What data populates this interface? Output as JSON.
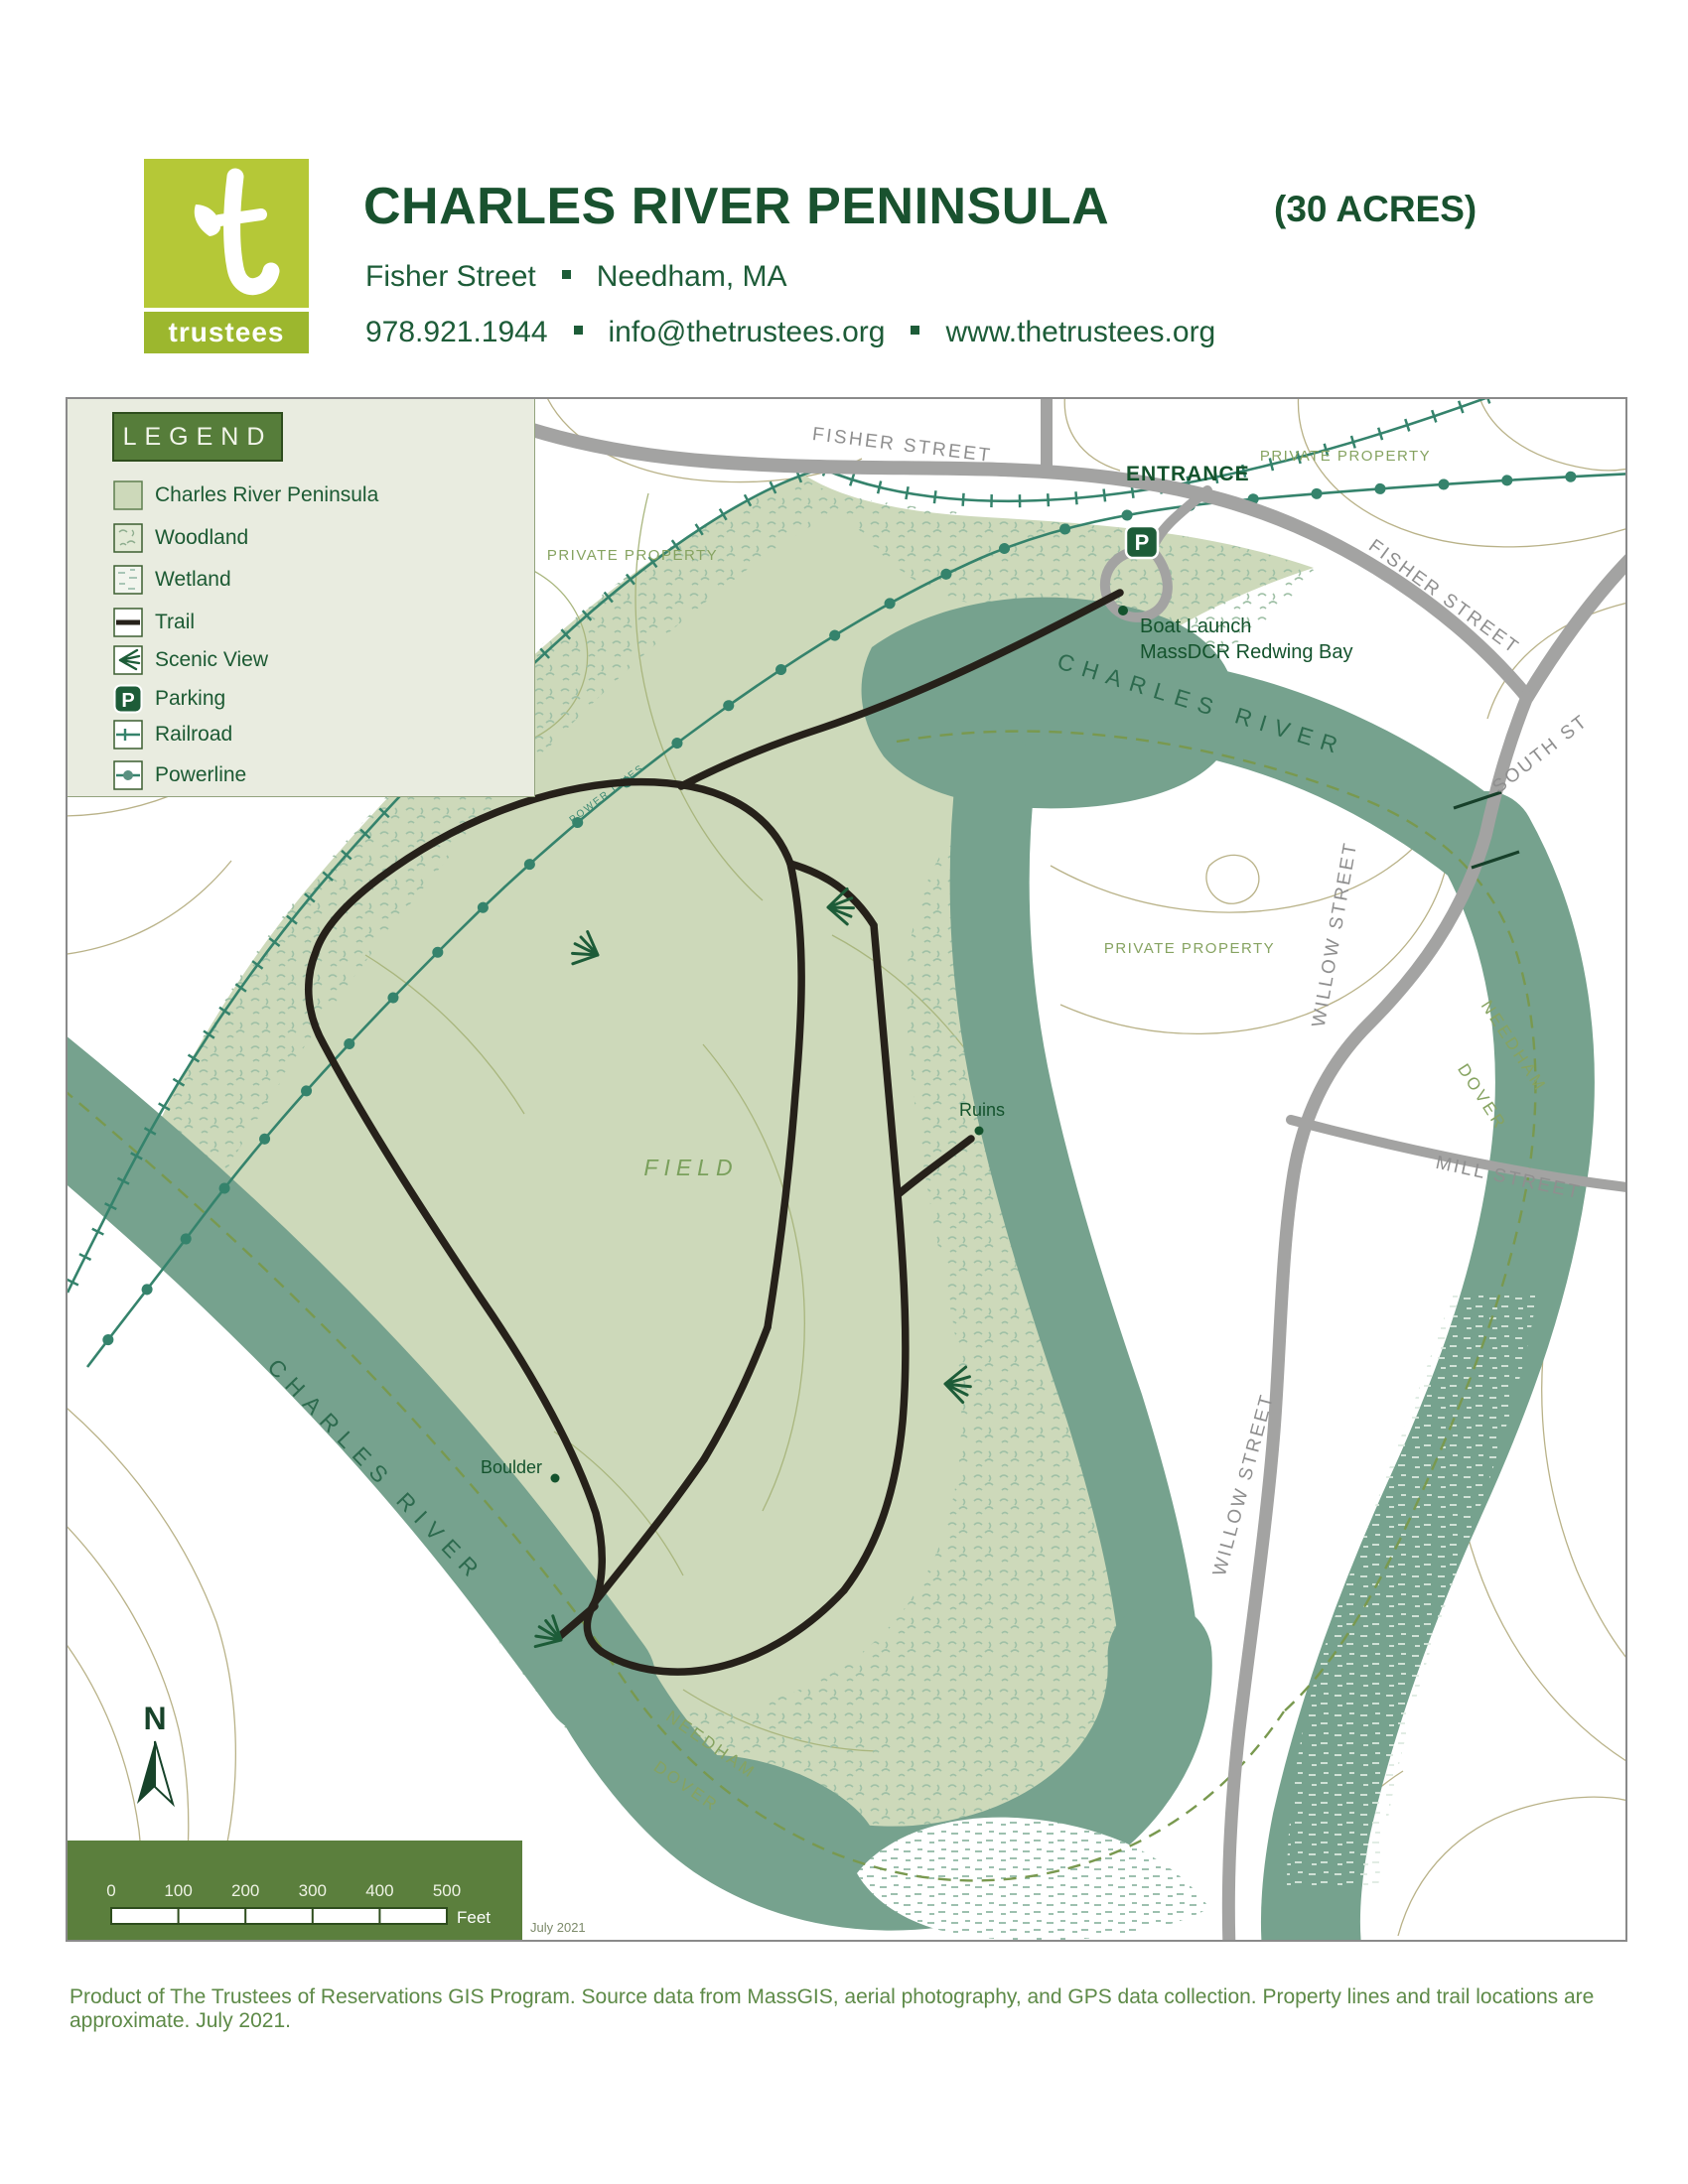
{
  "header": {
    "logo": {
      "letter": "t",
      "wordmark": "trustees"
    },
    "title": "CHARLES RIVER PENINSULA",
    "acreage": "(30 ACRES)",
    "address": {
      "street": "Fisher Street",
      "town": "Needham, MA"
    },
    "contact": {
      "phone": "978.921.1944",
      "email": "info@thetrustees.org",
      "website": "www.thetrustees.org"
    }
  },
  "legend": {
    "title": "LEGEND",
    "items": [
      {
        "key": "peninsula",
        "label": "Charles River Peninsula"
      },
      {
        "key": "woodland",
        "label": "Woodland"
      },
      {
        "key": "wetland",
        "label": "Wetland"
      },
      {
        "key": "trail",
        "label": "Trail"
      },
      {
        "key": "scenic-view",
        "label": "Scenic View"
      },
      {
        "key": "parking",
        "label": "Parking"
      },
      {
        "key": "railroad",
        "label": "Railroad"
      },
      {
        "key": "powerline",
        "label": "Powerline"
      }
    ]
  },
  "map": {
    "streets": {
      "fisher_top": "FISHER STREET",
      "fisher_east": "FISHER STREET",
      "south": "SOUTH ST",
      "willow_upper": "WILLOW STREET",
      "willow_lower": "WILLOW STREET",
      "mill": "MILL STREET"
    },
    "river_label": "CHARLES RIVER",
    "private_property": "PRIVATE PROPERTY",
    "entrance": "ENTRANCE",
    "power_lines": "POWER LINES",
    "boundary": {
      "needham": "NEEDHAM",
      "dover": "DOVER"
    },
    "poi": {
      "boat_launch": "Boat Launch",
      "boat_launch_detail": "MassDCR Redwing Bay",
      "ruins": "Ruins",
      "boulder": "Boulder",
      "field": "FIELD",
      "parking_symbol": "P"
    },
    "north_label": "N",
    "scale": {
      "ticks": [
        "0",
        "100",
        "200",
        "300",
        "400",
        "500"
      ],
      "unit": "Feet"
    },
    "date_note": "July 2021"
  },
  "footer": {
    "credit": "Product of The Trustees of Reservations GIS Program. Source data from MassGIS, aerial photography, and GPS data collection. Property lines and trail locations are approximate. July 2021."
  },
  "colors": {
    "brand_green": "#b5c837",
    "dark_green": "#14532d",
    "river": "#76a28e",
    "peninsula": "#cdd9ba",
    "legend_bg": "#e9ece0",
    "accent_olive": "#5b7f3d"
  }
}
